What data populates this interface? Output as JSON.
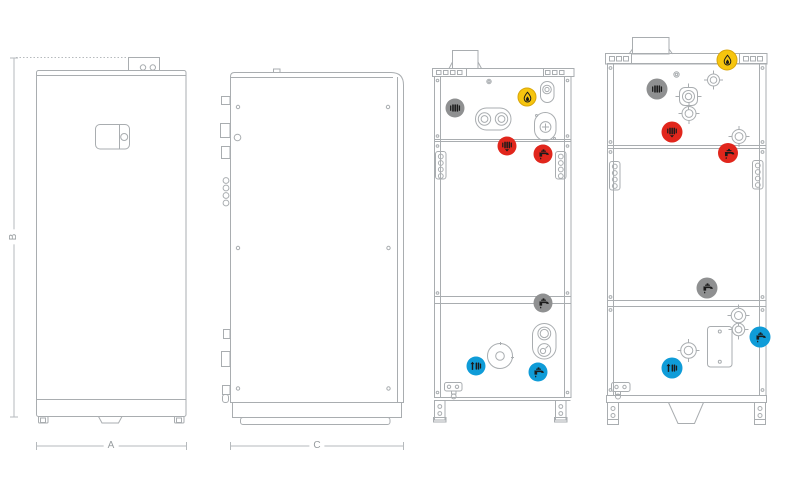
{
  "page": {
    "background": "#ffffff",
    "kind": "boiler-dimensional-drawing"
  },
  "dimension_labels": {
    "a": "A",
    "b": "B",
    "c": "C"
  },
  "views": {
    "front": "front-view",
    "side": "side-view",
    "rear_left": "rear-view-connections",
    "rear_right": "rear-view-connections-large"
  },
  "palette": {
    "line": "#a9adb0",
    "dimension_line": "#b6babd",
    "label_text": "#979c9f",
    "gas_yellow": "#f6c50e",
    "gas_yellow_border": "#d9a60a",
    "flow_red": "#e1261c",
    "return_blue": "#0f9cd8",
    "neutral_gray": "#8f9091",
    "icon_black": "#1b1b1b"
  },
  "connection_markers": {
    "rear_left": [
      {
        "type": "aux-heating-flow",
        "icon": "radiator-icon",
        "color": "#8f9091",
        "x": 455,
        "y": 108,
        "d": 19
      },
      {
        "type": "gas",
        "icon": "flame-icon",
        "color": "#f6c50e",
        "x": 527,
        "y": 97,
        "d": 19
      },
      {
        "type": "heating-flow",
        "icon": "radiator-down-icon",
        "color": "#e1261c",
        "x": 507,
        "y": 146,
        "d": 19
      },
      {
        "type": "hot-water",
        "icon": "tap-icon",
        "color": "#e1261c",
        "x": 543,
        "y": 154,
        "d": 19
      },
      {
        "type": "recirculation",
        "icon": "tap-icon",
        "color": "#8f9091",
        "x": 543,
        "y": 303,
        "d": 19
      },
      {
        "type": "heating-return",
        "icon": "radiator-up-icon",
        "color": "#0f9cd8",
        "x": 476,
        "y": 366,
        "d": 19
      },
      {
        "type": "cold-water",
        "icon": "tap-icon",
        "color": "#0f9cd8",
        "x": 538,
        "y": 372,
        "d": 19
      }
    ],
    "rear_right": [
      {
        "type": "gas",
        "icon": "flame-icon",
        "color": "#f6c50e",
        "x": 727,
        "y": 60,
        "d": 21
      },
      {
        "type": "aux-heating-flow",
        "icon": "radiator-icon",
        "color": "#8f9091",
        "x": 657,
        "y": 89,
        "d": 21
      },
      {
        "type": "heating-flow",
        "icon": "radiator-down-icon",
        "color": "#e1261c",
        "x": 672,
        "y": 132,
        "d": 21
      },
      {
        "type": "hot-water",
        "icon": "tap-icon",
        "color": "#e1261c",
        "x": 728,
        "y": 153,
        "d": 20
      },
      {
        "type": "recirculation",
        "icon": "tap-icon",
        "color": "#8f9091",
        "x": 707,
        "y": 288,
        "d": 21
      },
      {
        "type": "cold-water",
        "icon": "tap-icon",
        "color": "#0f9cd8",
        "x": 760,
        "y": 337,
        "d": 21
      },
      {
        "type": "heating-return",
        "icon": "radiator-up-icon",
        "color": "#0f9cd8",
        "x": 672,
        "y": 368,
        "d": 21
      }
    ]
  }
}
